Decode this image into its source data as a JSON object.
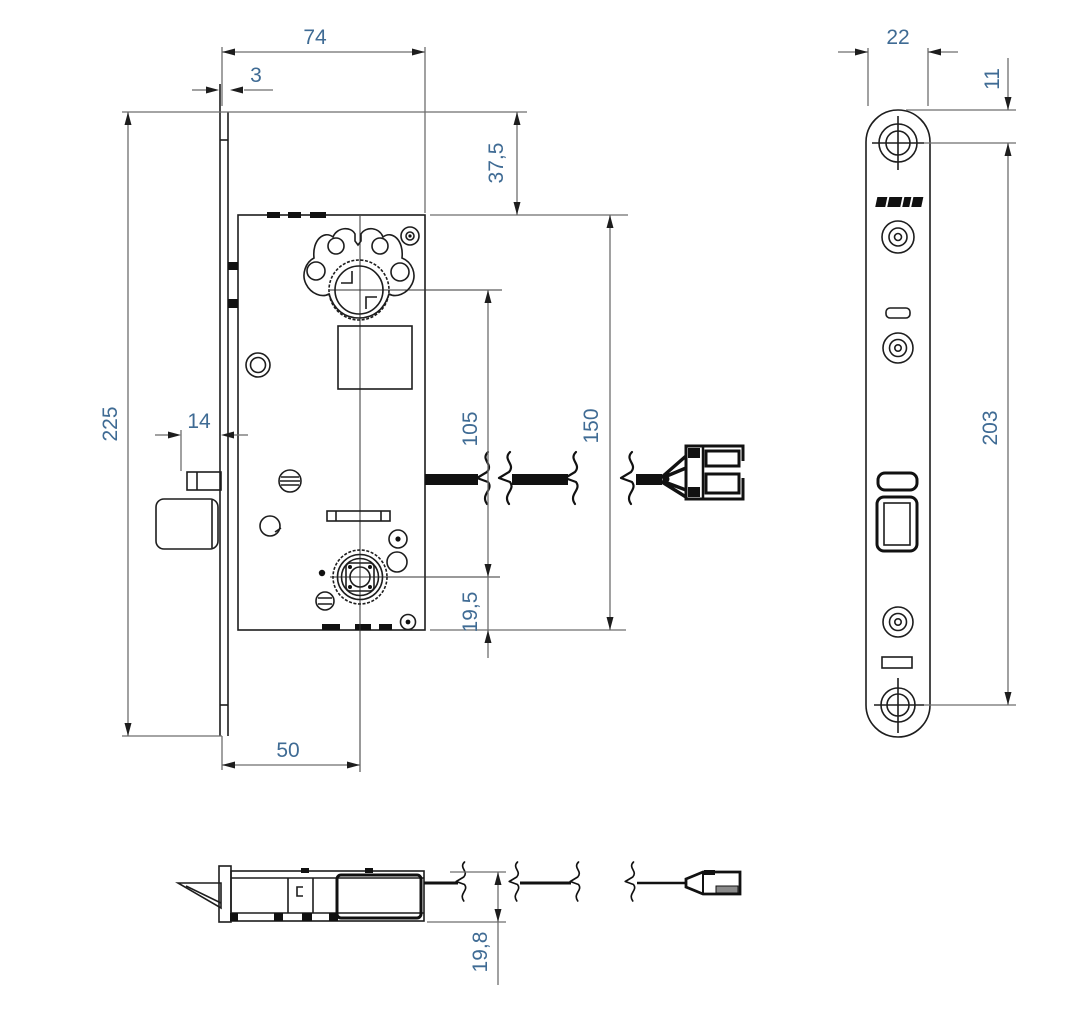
{
  "drawing": {
    "type": "mortise-lock technical drawing, three orthographic views",
    "colors": {
      "object_line": "#1d1d1d",
      "dimension_line": "#6e6e6e",
      "dimension_text": "#3f6b94",
      "background": "#ffffff"
    },
    "icons": {
      "brand_logo": "brand-logo-mark (illegible engraved logo on faceplate)"
    }
  },
  "dimensions": {
    "front_case_depth": "74",
    "front_faceplate_thickness": "3",
    "front_top_to_case": "37,5",
    "front_faceplate_length": "225",
    "front_latch_throw": "14",
    "front_centre_distance": "105",
    "front_case_height": "150",
    "front_follower_to_case_bottom": "19,5",
    "front_backset": "50",
    "side_faceplate_width": "22",
    "side_top_to_first_screw": "11",
    "side_screw_centres": "203",
    "bottom_case_thickness": "19,8"
  }
}
